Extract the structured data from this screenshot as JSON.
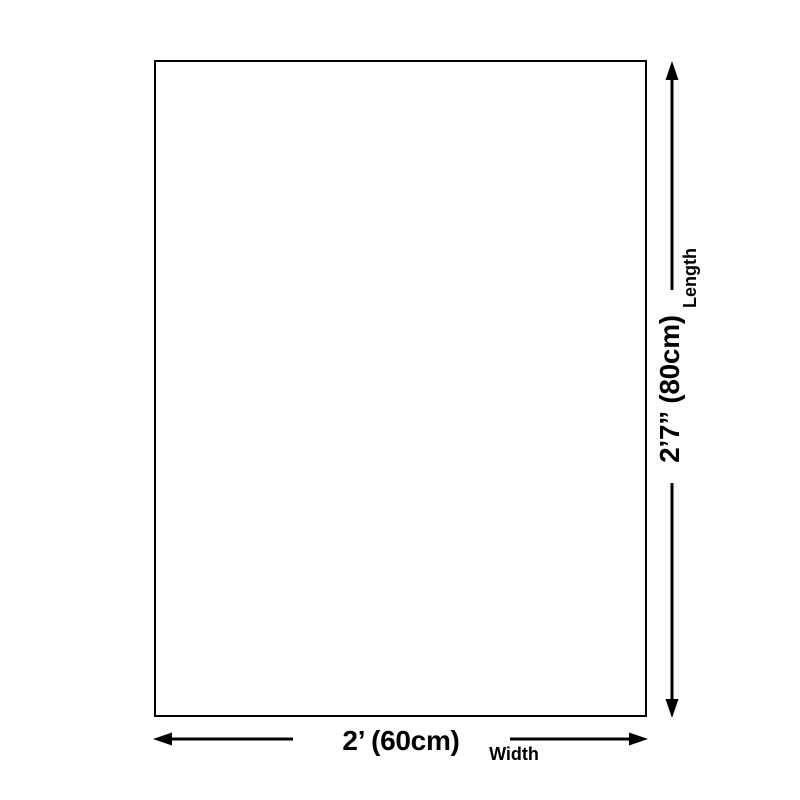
{
  "page": {
    "background_color": "#ffffff"
  },
  "diagram": {
    "outline": {
      "fill": "#ffffff",
      "border_color": "#000000"
    },
    "line_color": "#000000",
    "text_color": "#000000",
    "length_dimension": {
      "label": "Length",
      "value": "2’7” (80cm)"
    },
    "width_dimension": {
      "label": "Width",
      "value": "2’ (60cm)"
    },
    "icons": {
      "length_axis": "double-headed-arrow-vertical",
      "width_axis": "double-headed-arrow-horizontal"
    }
  }
}
